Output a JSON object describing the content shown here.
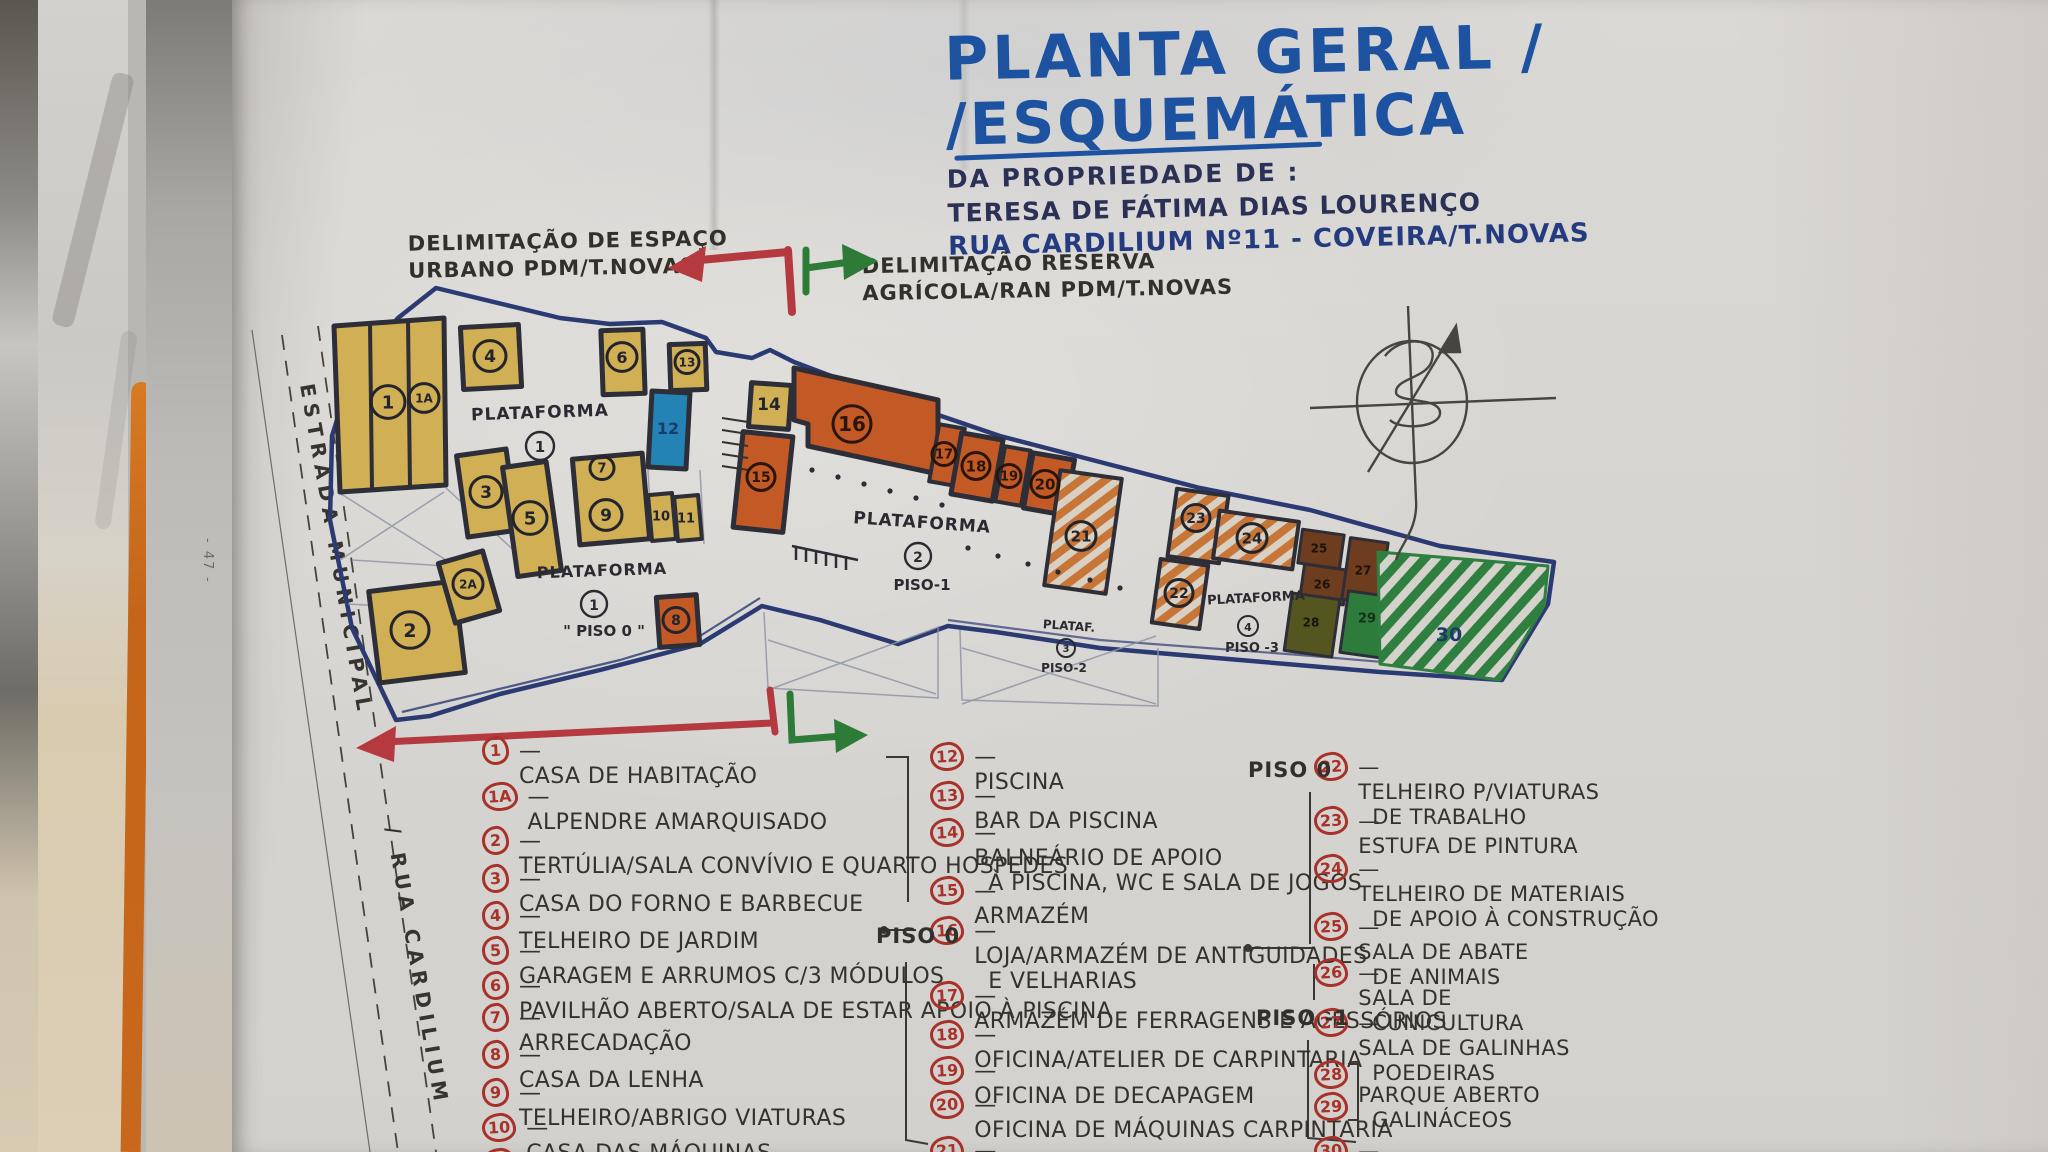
{
  "title": {
    "line1": "PLANTA GERAL /",
    "line2": "/ESQUEMÁTICA",
    "line3": "DA PROPRIEDADE DE :",
    "line4": "TERESA DE FÁTIMA DIAS LOURENÇO",
    "line5": "RUA CARDILIUM Nº11 - COVEIRA/T.NOVAS"
  },
  "notes": {
    "urban1": "DELIMITAÇÃO DE ESPAÇO",
    "urban2": "URBANO  PDM/T.NOVAS",
    "agri1": "DELIMITAÇÃO RESERVA",
    "agri2": "AGRÍCOLA/RAN  PDM/T.NOVAS",
    "road1": "ESTRADA  MUNICIPAL",
    "road2": "/ RUA  CARDILIUM",
    "margin_mark": "47"
  },
  "plan": {
    "platforms": {
      "p1": {
        "word": "PLATAFORMA",
        "num": "1",
        "piso": ""
      },
      "p1b": {
        "word": "PLATAFORMA",
        "num": "1",
        "piso": "\" PISO 0 \""
      },
      "p2": {
        "word": "PLATAFORMA",
        "num": "2",
        "piso": "PISO-1"
      },
      "p3": {
        "word": "PLATAF.",
        "num": "3",
        "piso": "PISO-2"
      },
      "p4": {
        "word": "PLATAFORMA",
        "num": "4",
        "piso": "PISO -3"
      }
    },
    "nums": {
      "n1": "1",
      "n1a": "1A",
      "n2": "2",
      "n2a": "2A",
      "n3": "3",
      "n4": "4",
      "n5": "5",
      "n6": "6",
      "n7": "7",
      "n8": "8",
      "n9": "9",
      "n10": "10",
      "n11": "11",
      "n12": "12",
      "n13": "13",
      "n14": "14",
      "n15": "15",
      "n16": "16",
      "n17": "17",
      "n18": "18",
      "n19": "19",
      "n20": "20",
      "n21": "21",
      "n22": "22",
      "n23": "23",
      "n24": "24",
      "n25": "25",
      "n26": "26",
      "n27": "27",
      "n28": "28",
      "n29": "29",
      "n30": "30"
    }
  },
  "legend": {
    "piso0_col2": "PISO 0",
    "piso0_col3": "PISO 0",
    "piso_m1_col3": "PISO -1",
    "col1": [
      {
        "num": "1",
        "text": "CASA DE HABITAÇÃO"
      },
      {
        "num": "1A",
        "text": "ALPENDRE AMARQUISADO"
      },
      {
        "num": "2",
        "text": "TERTÚLIA/SALA CONVÍVIO E QUARTO HOSPEDES"
      },
      {
        "num": "3",
        "text": "CASA DO FORNO E BARBECUE"
      },
      {
        "num": "4",
        "text": "TELHEIRO DE JARDIM"
      },
      {
        "num": "5",
        "text": "GARAGEM E ARRUMOS C/3 MÓDULOS"
      },
      {
        "num": "6",
        "text": "PAVILHÃO ABERTO/SALA DE ESTAR APOIO À PISCINA"
      },
      {
        "num": "7",
        "text": "ARRECADAÇÃO"
      },
      {
        "num": "8",
        "text": "CASA DA LENHA"
      },
      {
        "num": "9",
        "text": "TELHEIRO/ABRIGO VIATURAS"
      },
      {
        "num": "10",
        "text": "CASA DAS MÁQUINAS"
      },
      {
        "num": "11",
        "text": "SALA D"
      }
    ],
    "col2": [
      {
        "num": "12",
        "text": "PISCINA"
      },
      {
        "num": "13",
        "text": "BAR DA PISCINA"
      },
      {
        "num": "14",
        "text": "BALNEÁRIO DE APOIO",
        "text2": "À PISCINA, WC E SALA DE JOGOS"
      },
      {
        "num": "15",
        "text": "ARMAZÉM"
      },
      {
        "num": "16",
        "text": "LOJA/ARMAZÉM DE ANTIGUIDADES",
        "text2": "E VELHARIAS"
      },
      {
        "num": "17",
        "text": "ARMAZÉM DE FERRAGENS E ACESSÓRIOS"
      },
      {
        "num": "18",
        "text": "OFICINA/ATELIER DE CARPINTARIA"
      },
      {
        "num": "19",
        "text": "OFICINA DE DECAPAGEM"
      },
      {
        "num": "20",
        "text": "OFICINA DE MÁQUINAS CARPINTARIA"
      },
      {
        "num": "21",
        "text": "ARMAZÉM DE ESTALEIRO PISO-2"
      }
    ],
    "col3": [
      {
        "num": "22",
        "text": "TELHEIRO P/VIATURAS",
        "text2": "DE TRABALHO"
      },
      {
        "num": "23",
        "text": "ESTUFA DE PINTURA"
      },
      {
        "num": "24",
        "text": "TELHEIRO DE MATERIAIS",
        "text2": "DE APOIO À CONSTRUÇÃO"
      },
      {
        "num": "25",
        "text": "SALA DE ABATE",
        "text2": "DE ANIMAIS"
      },
      {
        "num": "26",
        "text": "SALA DE",
        "text2": "CUNICULTURA"
      },
      {
        "num": "27",
        "text": "SALA DE GALINHAS",
        "text2": "POEDEIRAS"
      },
      {
        "num": "28",
        "text": ""
      },
      {
        "num": "29",
        "text": "PARQUE ABERTO",
        "text2": "GALINÁCEOS"
      },
      {
        "num": "30",
        "text": "TERRENO RESTANTE"
      }
    ]
  },
  "colors": {
    "marker_blue": "#1d52a0",
    "pen_navy": "#2b3057",
    "pen_black": "#37332e",
    "pen_red": "#a8322a",
    "arrow_red": "#b43a40",
    "arrow_green": "#2e7b37",
    "boundary": "#2c3a74",
    "bldg_yellow": "#d1af55",
    "bldg_orange": "#c35a26",
    "pool_blue": "#2383b4",
    "brown": "#6e3c1e",
    "olive": "#55561f",
    "green": "#2e7c3c"
  }
}
